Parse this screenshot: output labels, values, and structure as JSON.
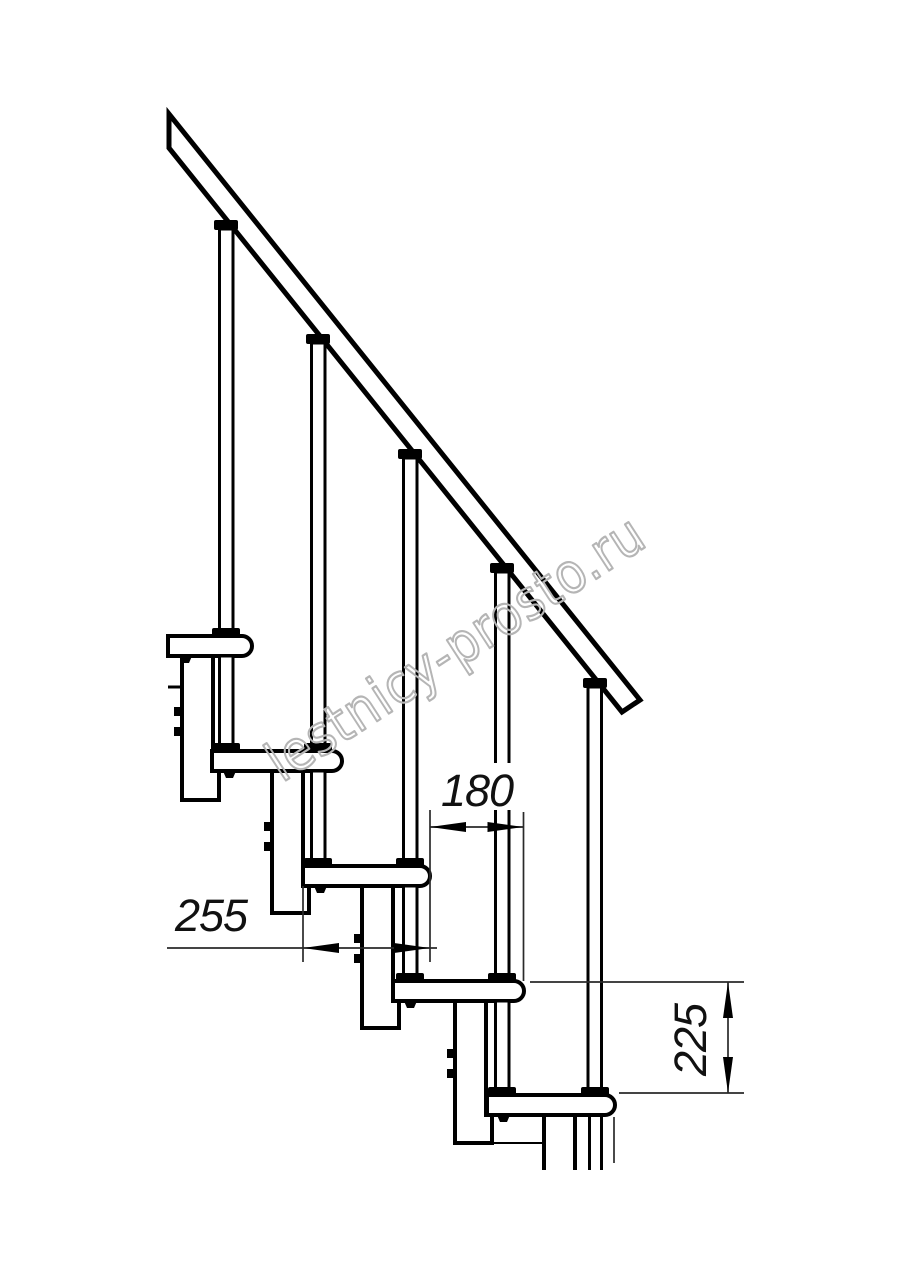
{
  "drawing": {
    "dimension_labels": {
      "run": "180",
      "depth": "255",
      "rise": "225"
    },
    "watermark_text": "lestnicy-prosto.ru",
    "colors": {
      "line": "#000000",
      "dimension": "#2a2a2a",
      "watermark": "#b5b5b5",
      "background": "#ffffff"
    }
  }
}
